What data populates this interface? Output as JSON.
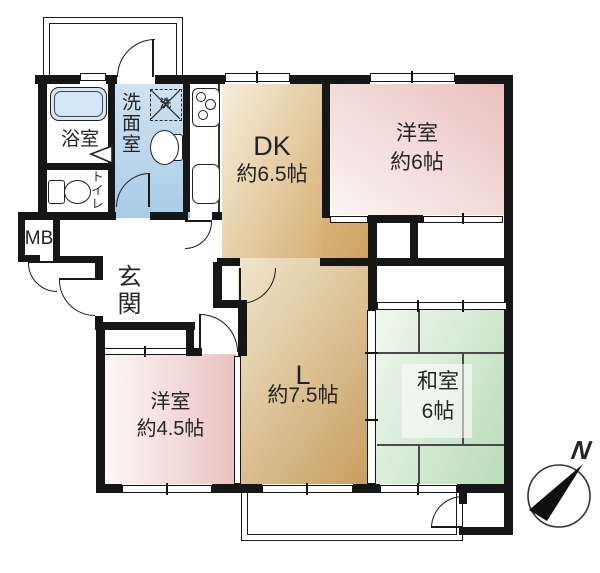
{
  "floorplan": {
    "rooms": {
      "dk": {
        "label": "DK",
        "size": "約6.5帖"
      },
      "living": {
        "label": "L",
        "size": "約7.5帖"
      },
      "western6": {
        "label": "洋室",
        "size": "約6帖"
      },
      "japanese": {
        "label": "和室",
        "size": "6帖"
      },
      "western45": {
        "label": "洋室",
        "size": "約4.5帖"
      },
      "bath": {
        "label": "浴室"
      },
      "washroom": {
        "label": "洗面室"
      },
      "toilet": {
        "label": "トイレ"
      },
      "entrance": {
        "label": "玄関"
      },
      "meter_box": {
        "label": "MB"
      }
    },
    "fixtures": {
      "washing_machine_label": "洗"
    },
    "compass": {
      "north": "N"
    },
    "colors": {
      "wall": "#161616",
      "ldk_tan": "#d0a768",
      "western_pink": "#ecc5c3",
      "japanese_green": "#c0e0c0",
      "washroom_blue": "#afd0e8",
      "bathtub_blue": "#d3e7f6"
    }
  }
}
